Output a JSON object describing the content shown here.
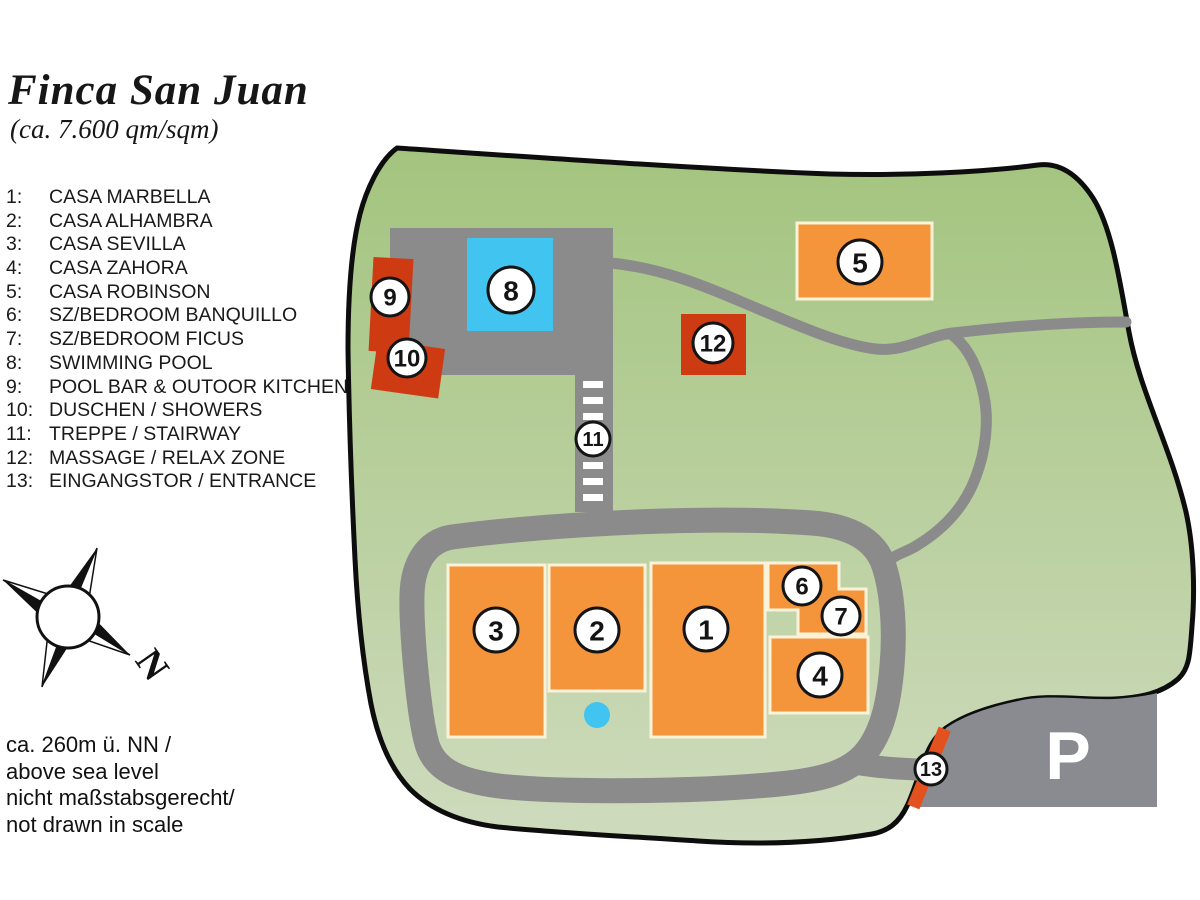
{
  "title": "Finca San Juan",
  "subtitle": "(ca. 7.600 qm/sqm)",
  "legend": {
    "items": [
      {
        "num": "1:",
        "label": "CASA MARBELLA"
      },
      {
        "num": "2:",
        "label": "CASA ALHAMBRA"
      },
      {
        "num": "3:",
        "label": "CASA SEVILLA"
      },
      {
        "num": "4:",
        "label": "CASA ZAHORA"
      },
      {
        "num": "5:",
        "label": "CASA ROBINSON"
      },
      {
        "num": "6:",
        "label": "SZ/BEDROOM BANQUILLO"
      },
      {
        "num": "7:",
        "label": "SZ/BEDROOM FICUS"
      },
      {
        "num": "8:",
        "label": "SWIMMING POOL"
      },
      {
        "num": "9:",
        "label": "POOL BAR & OUTOOR KITCHEN"
      },
      {
        "num": "10:",
        "label": "DUSCHEN / SHOWERS"
      },
      {
        "num": "11:",
        "label": "TREPPE / STAIRWAY"
      },
      {
        "num": "12:",
        "label": "MASSAGE / RELAX ZONE"
      },
      {
        "num": "13:",
        "label": "EINGANGSTOR / ENTRANCE"
      }
    ]
  },
  "compass": {
    "label": "N"
  },
  "notes": {
    "lines": [
      "ca. 260m ü. NN /",
      "above sea level",
      "nicht maßstabsgerecht/",
      "not drawn in scale"
    ]
  },
  "map": {
    "parking_label": "P",
    "markers": [
      {
        "label": "1"
      },
      {
        "label": "2"
      },
      {
        "label": "3"
      },
      {
        "label": "4"
      },
      {
        "label": "5"
      },
      {
        "label": "6"
      },
      {
        "label": "7"
      },
      {
        "label": "8"
      },
      {
        "label": "9"
      },
      {
        "label": "10"
      },
      {
        "label": "11"
      },
      {
        "label": "12"
      },
      {
        "label": "13"
      }
    ],
    "colors": {
      "ground_top": "#A3C47E",
      "ground_bottom": "#CFDBBE",
      "boundary": "#0D0D0D",
      "road": "#8B8B8B",
      "pool_blue": "#41C4EF",
      "building_orange": "#F5953B",
      "building_border": "#FAF3DA",
      "building_red": "#CE3B13",
      "gate_red": "#E2511E",
      "parking_gray": "#8A8B90",
      "marker_fill": "#FFFFFF",
      "marker_stroke": "#141414"
    }
  }
}
